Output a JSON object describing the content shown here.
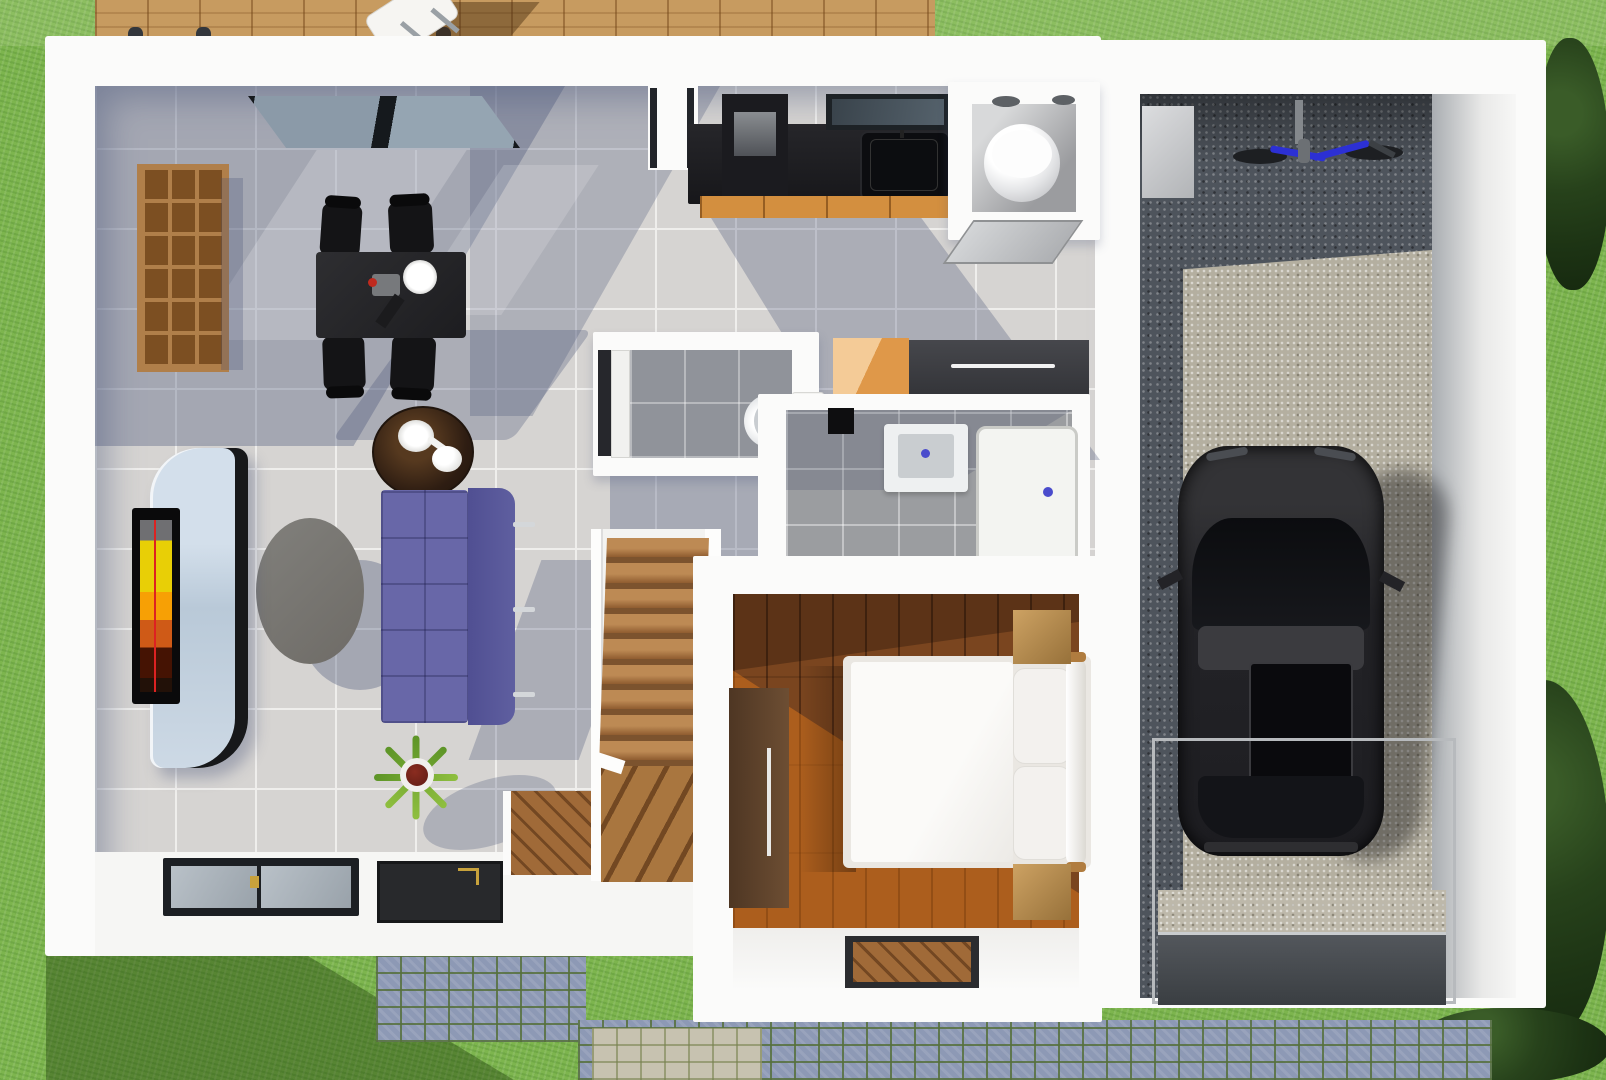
{
  "scene": {
    "label": "3D rendered top-down floor plan of a single-storey house with attached garage",
    "view": "top-down orthographic render",
    "type": "architectural visualization"
  },
  "palette": {
    "grass_green": "#7db54e",
    "deck_wood": "#c79b60",
    "wall_white": "#fbfbfa",
    "floor_tile": "#d6d4d2",
    "shadow_blue": "#8f9ab4",
    "bedroom_wood": "#7a451f",
    "kitchen_counter_black": "#1b1b1e",
    "cabinet_orange": "#d38f3f",
    "sofa_purple": "#6867a8",
    "coffee_table_gray": "#787672",
    "gravel_dark": "#4e545c",
    "gravel_light": "#b4afa0",
    "car_black": "#232327",
    "cobblestone_blue": "#8d99b5",
    "cobble_joint_green": "#5d7a42",
    "bicycle_blue": "#2c30d4",
    "drain_dot_blue": "#4a4ccc",
    "bookshelf_wood": "#a9713a",
    "stair_wood": "#a9763f"
  },
  "exterior": {
    "label": "Yard and surroundings",
    "items": [
      "lawn",
      "wood-deck-terrace",
      "folding-deck-chair",
      "deck-bollards",
      "cobblestone-path",
      "trees-and-bushes"
    ]
  },
  "rooms": {
    "living": {
      "label": "Living / dining room",
      "furniture": [
        "wooden-cubby-bookshelf",
        "black-dining-table",
        "dining-chairs-x4",
        "white-plate",
        "round-dark-side-table",
        "tea-set",
        "purple-tufted-sofa",
        "oval-gray-coffee-table",
        "curved-tv-console",
        "wall-mounted-tv",
        "potted-spiky-plant",
        "sliding-glass-window-top",
        "floor-windows-bottom",
        "wood-entry-door"
      ]
    },
    "kitchen": {
      "label": "Kitchen",
      "furniture": [
        "black-countertop",
        "black-sink-with-faucet",
        "tall-black-appliance",
        "orange-base-cabinets",
        "window-above-sink",
        "deck-door"
      ]
    },
    "toilet_top": {
      "label": "Toilet room (top)",
      "furniture": [
        "round-white-toilet",
        "ceiling-vents-x2",
        "open-gray-door"
      ]
    },
    "wc": {
      "label": "Guest WC",
      "furniture": [
        "toilet-with-cistern",
        "pocket-door"
      ]
    },
    "bathroom": {
      "label": "Shower room",
      "furniture": [
        "washbasin-cabinet",
        "shower-tray",
        "black-wall-niche"
      ]
    },
    "storage": {
      "label": "Hall storage",
      "furniture": [
        "orange-corner-cabinet",
        "dark-gray-wardrobe"
      ]
    },
    "stairs": {
      "label": "Staircase",
      "furniture": [
        "straight-wood-treads-x9",
        "winder-steps"
      ]
    },
    "bedroom": {
      "label": "Bedroom",
      "furniture": [
        "double-bed-white-duvet",
        "pillows-x2",
        "bolster-headboard",
        "nightstands-x2",
        "tall-wardrobe",
        "framed-wood-doormat"
      ]
    },
    "garage": {
      "label": "Garage",
      "furniture": [
        "black-car-top-view",
        "blue-bicycle",
        "gray-storage-block",
        "glass-door-frame",
        "entry-ramp"
      ]
    }
  }
}
